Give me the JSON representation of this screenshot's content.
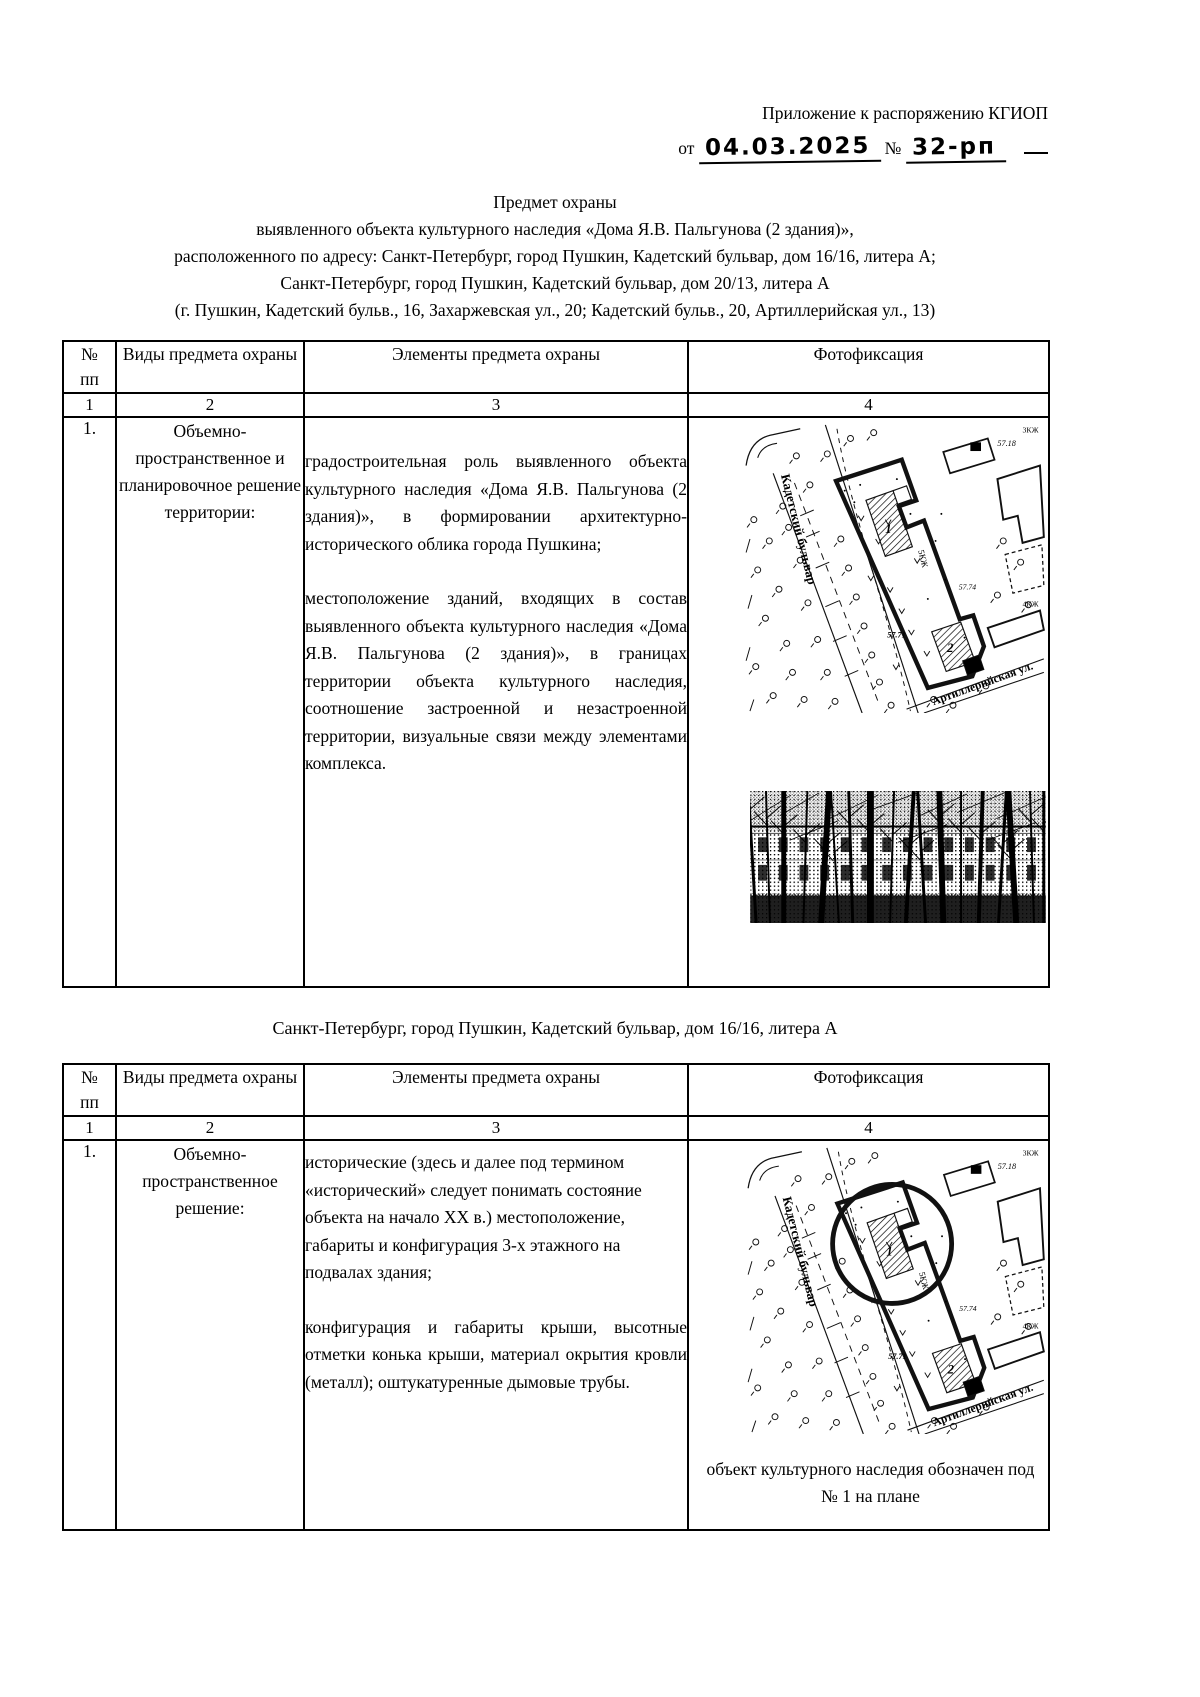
{
  "page": {
    "header_line1": "Приложение к распоряжению КГИОП",
    "from_label": "от",
    "date_value": "04.03.2025",
    "number_sign": "№",
    "number_value": "32-рп"
  },
  "title_lines": [
    "Предмет охраны",
    "выявленного объекта культурного наследия «Дома Я.В. Пальгунова (2 здания)»,",
    "расположенного по адресу: Санкт-Петербург, город Пушкин, Кадетский бульвар, дом 16/16, литера А;",
    "Санкт-Петербург, город Пушкин, Кадетский бульвар, дом 20/13, литера А",
    "(г. Пушкин, Кадетский бульв., 16, Захаржевская ул., 20; Кадетский бульв., 20, Артиллерийская ул., 13)"
  ],
  "columns": {
    "num": "№",
    "num2": "пп",
    "kind": "Виды предмета охраны",
    "elements": "Элементы предмета охраны",
    "photo": "Фотофиксация",
    "order": [
      "1",
      "2",
      "3",
      "4"
    ]
  },
  "table1": {
    "row_index": "1.",
    "kind": "Объемно-пространственное и планировочное решение территории:",
    "para1": "градостроительная роль выявленного объекта культурного наследия «Дома Я.В. Пальгунова (2 здания)», в формировании архитектурно-исторического облика города Пушкина;",
    "para2": "местоположение зданий, входящих в состав выявленного объекта культурного наследия «Дома Я.В. Пальгунова (2 здания)», в границах территории объекта культурного наследия, соотношение застроенной и незастроенной территории, визуальные связи между элементами комплекса."
  },
  "section2_heading": "Санкт-Петербург, город Пушкин, Кадетский бульвар, дом 16/16, литера А",
  "table2": {
    "row_index": "1.",
    "kind": "Объемно-пространственное решение:",
    "para1": "исторические (здесь и далее под термином «исторический» следует понимать состояние объекта на начало XX в.) местоположение, габариты и конфигурация 3-х этажного на подвалах здания;",
    "para2": "конфигурация и габариты крыши, высотные отметки конька крыши, материал окрытия кровли (металл); оштукатуренные дымовые трубы.",
    "map_caption": "объект культурного наследия обозначен под № 1 на плане"
  },
  "map_labels": {
    "street_boulevard": "Кадетский бульвар",
    "street_artillery": "Артиллерийская ул.",
    "building1": "1",
    "building2": "2",
    "elevation1": "57.18",
    "elevation2": "57.74",
    "elevation3": "57.71",
    "storeys_main": "5КЖ",
    "storeys_top": "3КЖ",
    "storeys_right": "4КЖ"
  }
}
